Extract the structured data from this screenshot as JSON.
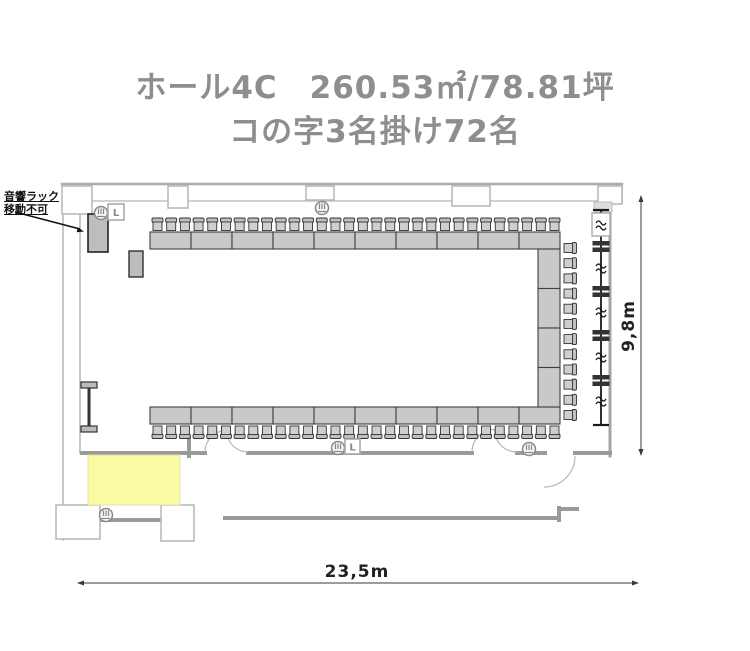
{
  "title": {
    "line1": "ホール4C　260.53㎡/78.81坪",
    "line2": "コの字3名掛け72名"
  },
  "room": {
    "name": "ホール4C",
    "area_sqm": "260.53",
    "area_tsubo": "78.81",
    "layout_style": "コの字3名掛け",
    "capacity": 72
  },
  "annotation": {
    "line1": "音響ラック",
    "line2": "移動不可"
  },
  "dimensions": {
    "width_label": "23,5m",
    "height_label": "9,8m"
  },
  "speaker": {
    "label": "L"
  },
  "furniture": {
    "top_row": {
      "tables": 10,
      "chairs": 30
    },
    "bottom_row": {
      "tables": 10,
      "chairs": 30
    },
    "right_column": {
      "tables": 4,
      "chairs": 12
    }
  },
  "colors": {
    "title": "#8e8e8e",
    "wall_thick": "#9a9a9a",
    "wall_light": "#b5b5b5",
    "table_fill": "#c9c9c9",
    "table_stroke": "#3f3f3f",
    "chair_fill": "#cfcfcf",
    "stage_fill": "#fafaa5",
    "partition": "#1a1a1a",
    "dimension": "#3a3a3a"
  }
}
